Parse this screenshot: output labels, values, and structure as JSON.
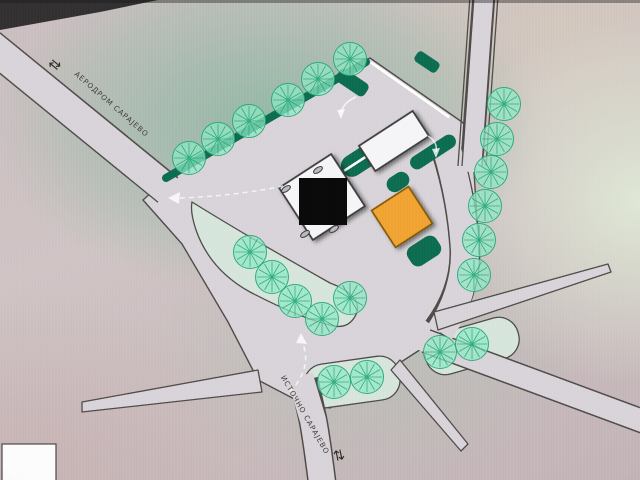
{
  "labels": {
    "airport_road": "АЕРОДРОМ САРАЈЕВО",
    "east_sarajevo_road": "ИСТОЧНО САРАЈЕВО",
    "airport_arrow": "⇄",
    "east_arrow": "⇅"
  },
  "colors": {
    "road_fill": "#d7d3d8",
    "road_edge": "#4f4b48",
    "island_fill": "#d6e5db",
    "hedge": "#0d6b50",
    "tree_fill": "#8fe8c4",
    "tree_vein": "#21a376",
    "building_white": "#f5f4f6",
    "building_orange": "#f0a230",
    "redaction": "#0a0a0a",
    "parking_stripe": "#ffffff"
  },
  "map": {
    "tree_radius": 16.5,
    "trees": [
      [
        189,
        158
      ],
      [
        218,
        139
      ],
      [
        249,
        121
      ],
      [
        288,
        100
      ],
      [
        318,
        79
      ],
      [
        350,
        59
      ],
      [
        504,
        104
      ],
      [
        497,
        139
      ],
      [
        491,
        172
      ],
      [
        485,
        206
      ],
      [
        479,
        240
      ],
      [
        474,
        275
      ],
      [
        250,
        252
      ],
      [
        272,
        277
      ],
      [
        295,
        301
      ],
      [
        322,
        319
      ],
      [
        350,
        298
      ],
      [
        334,
        382
      ],
      [
        367,
        377
      ],
      [
        440,
        352
      ],
      [
        472,
        344
      ]
    ],
    "parking_rows": [
      {
        "name": "north-parking-row",
        "count": 13,
        "start_x": 376,
        "start_y": 66,
        "step_x": 5.66,
        "step_y": 3.96,
        "stripe_len": 13,
        "stripe_w": 2.6,
        "angle": 125
      },
      {
        "name": "inner-parking-row",
        "count": 8,
        "start_x": 350,
        "start_y": 167,
        "step_x": 4.7,
        "step_y": -3.05,
        "stripe_len": 14,
        "stripe_w": 2.4,
        "angle": 57
      }
    ],
    "roof_vents": [
      [
        318,
        170
      ],
      [
        286,
        189
      ],
      [
        334,
        229
      ],
      [
        305,
        234
      ]
    ]
  },
  "legend_box": {
    "text": ""
  }
}
